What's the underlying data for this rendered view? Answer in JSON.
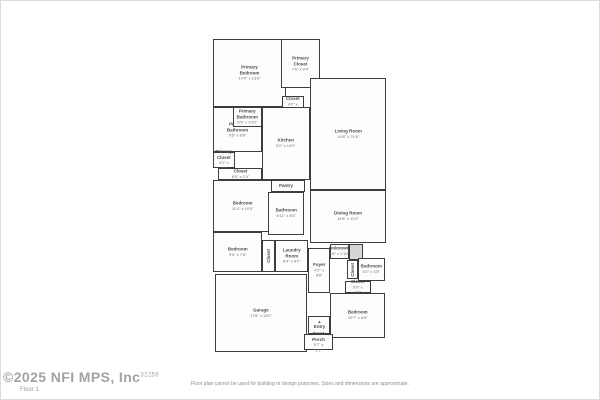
{
  "watermark": {
    "text": "©2025 NFI MPS, Inc",
    "sup": "32259",
    "floor_label": "Floor 1"
  },
  "footer": {
    "disclaimer": "Floor plan cannot be used for building or design purposes. Sizes and dimensions are approximate."
  },
  "colors": {
    "wall": "#3d3d3d",
    "room_fill": "#fdfdfd",
    "shaded_fill": "#d6d6d6",
    "label_text": "#4a4a4a",
    "dims_text": "#707070",
    "watermark_text": "#a2a2a2",
    "frame_border": "#dcdcdc"
  },
  "floorplan": {
    "rooms": [
      {
        "id": "primary-bedroom",
        "x": 213,
        "y": 39,
        "w": 73,
        "h": 68,
        "name": "Primary Bedroom",
        "dims": "14'0\" x 13'0\""
      },
      {
        "id": "primary-closet",
        "x": 281,
        "y": 39,
        "w": 39,
        "h": 49,
        "name": "Primary Closet",
        "dims": "7'6\" x 9'4\""
      },
      {
        "id": "hall-closet",
        "x": 282,
        "y": 96,
        "w": 22,
        "h": 16,
        "name": "Closet",
        "dims": "4'2\" x 3'0\""
      },
      {
        "id": "primary-bathroom",
        "x": 213,
        "y": 107,
        "w": 49,
        "h": 45,
        "name": "Primary Bathroom",
        "dims": "9'5\" x 8'8\""
      },
      {
        "id": "primary-bathroom-wc",
        "x": 233,
        "y": 107,
        "w": 29,
        "h": 20,
        "name": "Primary\nBathroom",
        "dims": "5'5\" x 3'10\""
      },
      {
        "id": "primary-closet-2",
        "x": 213,
        "y": 152,
        "w": 22,
        "h": 16,
        "name": "Primary\nCloset",
        "dims": "4'1\" x 3'0\""
      },
      {
        "id": "linen-closet",
        "x": 218,
        "y": 168,
        "w": 44,
        "h": 12,
        "name": "Closet",
        "dims": "8'5\" x 2'4\""
      },
      {
        "id": "kitchen",
        "x": 262,
        "y": 107,
        "w": 48,
        "h": 73,
        "name": "Kitchen",
        "dims": "9'2\" x 14'0\""
      },
      {
        "id": "living-room",
        "x": 310,
        "y": 78,
        "w": 76,
        "h": 112,
        "name": "Living Room",
        "dims": "14'8\" x 21'6\""
      },
      {
        "id": "pantry",
        "x": 267,
        "y": 180,
        "w": 38,
        "h": 12,
        "name": "Pantry"
      },
      {
        "id": "bedroom-2",
        "x": 213,
        "y": 180,
        "w": 59,
        "h": 52,
        "name": "Bedroom",
        "dims": "11'4\" x 10'0\""
      },
      {
        "id": "bathroom-2",
        "x": 268,
        "y": 192,
        "w": 36,
        "h": 43,
        "name": "Bathroom",
        "dims": "6'11\" x 8'3\""
      },
      {
        "id": "dining-room",
        "x": 310,
        "y": 190,
        "w": 76,
        "h": 53,
        "name": "Dining Room",
        "dims": "14'8\" x 10'2\""
      },
      {
        "id": "bedroom-3",
        "x": 213,
        "y": 232,
        "w": 49,
        "h": 40,
        "name": "Bedroom",
        "dims": "9'5\" x 7'8\""
      },
      {
        "id": "closet-3",
        "x": 262,
        "y": 240,
        "w": 13,
        "h": 32,
        "name": "Closet",
        "vertical": true
      },
      {
        "id": "laundry-room",
        "x": 275,
        "y": 240,
        "w": 33,
        "h": 32,
        "name": "Laundry Room",
        "dims": "6'4\" x 6'2\""
      },
      {
        "id": "foyer",
        "x": 308,
        "y": 248,
        "w": 22,
        "h": 45,
        "name": "Foyer",
        "dims": "4'2\" x 8'8\""
      },
      {
        "id": "unknown",
        "x": 330,
        "y": 244,
        "w": 19,
        "h": 15,
        "name": "Unknown",
        "dims": "3'8\" x 2'10\""
      },
      {
        "id": "stairs",
        "x": 349,
        "y": 244,
        "w": 14,
        "h": 16,
        "shaded": true
      },
      {
        "id": "closet-4",
        "x": 347,
        "y": 260,
        "w": 11,
        "h": 19,
        "name": "Closet",
        "vertical": true
      },
      {
        "id": "bathroom-3",
        "x": 358,
        "y": 258,
        "w": 27,
        "h": 23,
        "name": "Bathroom",
        "dims": "5'2\" x 4'5\""
      },
      {
        "id": "closet-5",
        "x": 345,
        "y": 281,
        "w": 26,
        "h": 12,
        "name": "Closet",
        "dims": "5'0\" x 2'4\""
      },
      {
        "id": "bedroom-4",
        "x": 330,
        "y": 293,
        "w": 55,
        "h": 45,
        "name": "Bedroom",
        "dims": "10'7\" x 8'8\""
      },
      {
        "id": "garage",
        "x": 215,
        "y": 274,
        "w": 92,
        "h": 78,
        "name": "Garage",
        "dims": "17'8\" x 15'0\""
      },
      {
        "id": "entry",
        "x": 308,
        "y": 316,
        "w": 22,
        "h": 18,
        "name": "Entry",
        "arrow": true
      },
      {
        "id": "front-porch",
        "x": 304,
        "y": 334,
        "w": 29,
        "h": 16,
        "name": "Front Porch",
        "dims": "5'7\" x 3'1\""
      }
    ]
  }
}
